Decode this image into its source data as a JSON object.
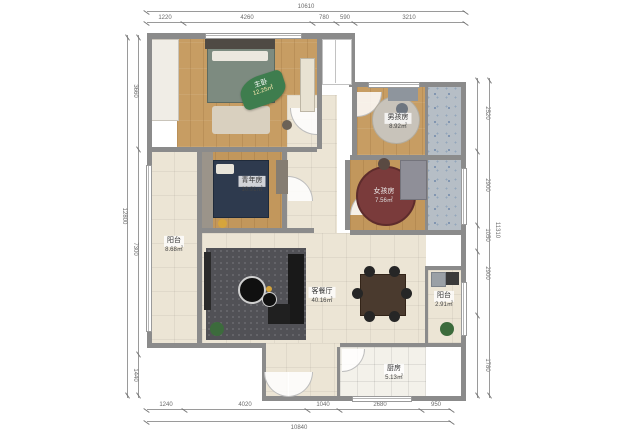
{
  "plan_title": "apartment-floor-plan",
  "dimensions": {
    "top": {
      "overall": "10610",
      "segments": [
        "1220",
        "4260",
        "780",
        "590",
        "3210"
      ]
    },
    "bottom": {
      "overall": "10840",
      "segments": [
        "1240",
        "4020",
        "1040",
        "2680",
        "950"
      ]
    },
    "left": {
      "overall": "12800",
      "segments": [
        "3660",
        "7300",
        "1440"
      ]
    },
    "right": {
      "overall": "11310",
      "segments": [
        "2520",
        "2900",
        "1050",
        "2900",
        "1780"
      ]
    }
  },
  "rooms": {
    "master": {
      "name": "主卧",
      "area": "12.25㎡"
    },
    "youth": {
      "name": "青年房",
      "area": "10.91㎡"
    },
    "boy": {
      "name": "男孩房",
      "area": "8.92㎡"
    },
    "girl": {
      "name": "女孩房",
      "area": "7.56㎡"
    },
    "balcony_left": {
      "name": "阳台",
      "area": "8.68㎡"
    },
    "living": {
      "name": "客餐厅",
      "area": "40.16㎡"
    },
    "balcony_right": {
      "name": "阳台",
      "area": "2.91㎡"
    },
    "kitchen": {
      "name": "厨房",
      "area": "5.13㎡"
    }
  },
  "colors": {
    "wall": "#8b8b8b",
    "wood_floor": "#c79d63",
    "tile_floor": "#ece5d5",
    "bath_floor": "#b6bec6",
    "leaf_label": "#3e7d4e",
    "rug_girl": "#7a3b3b",
    "bed_youth": "#2e3a4e"
  }
}
